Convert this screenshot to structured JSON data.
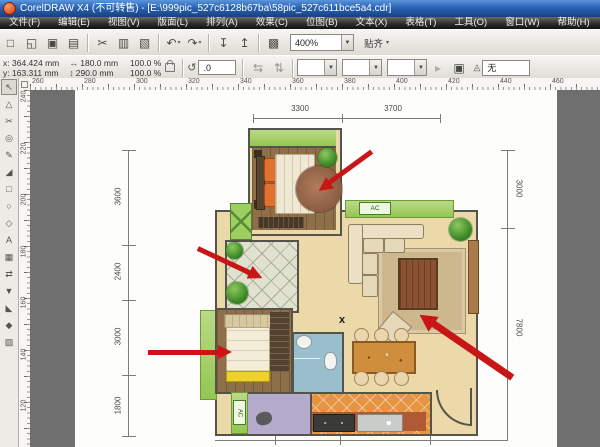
{
  "window": {
    "title": "CorelDRAW X4 (不可转售) - [E:\\999pic_527c6128b67ba\\58pic_527c611bce5a4.cdr]"
  },
  "menubar": {
    "items": [
      "文件(F)",
      "编辑(E)",
      "视图(V)",
      "版面(L)",
      "排列(A)",
      "效果(C)",
      "位图(B)",
      "文本(X)",
      "表格(T)",
      "工具(O)",
      "窗口(W)",
      "帮助(H)"
    ]
  },
  "toolbar": {
    "icons": [
      {
        "name": "new-document-icon",
        "glyph": "□"
      },
      {
        "name": "open-icon",
        "glyph": "◱"
      },
      {
        "name": "save-icon",
        "glyph": "▣"
      },
      {
        "name": "print-icon",
        "glyph": "▤"
      },
      {
        "sep": true
      },
      {
        "name": "cut-icon",
        "glyph": "✂"
      },
      {
        "name": "copy-icon",
        "glyph": "▥"
      },
      {
        "name": "paste-icon",
        "glyph": "▧"
      },
      {
        "sep": true
      },
      {
        "name": "undo-icon",
        "glyph": "↶",
        "caret": true
      },
      {
        "name": "redo-icon",
        "glyph": "↷",
        "caret": true
      },
      {
        "sep": true
      },
      {
        "name": "import-icon",
        "glyph": "↧"
      },
      {
        "name": "export-icon",
        "glyph": "↥"
      },
      {
        "sep": true
      },
      {
        "name": "app-launcher-icon",
        "glyph": "▩"
      }
    ],
    "zoom_value": "400%",
    "snap_label": "贴齐",
    "snap_caret": "▾"
  },
  "property_bar": {
    "x_label": "x:",
    "x_value": "364.424 mm",
    "y_label": "y:",
    "y_value": "163.311 mm",
    "w_value": "180.0 mm",
    "h_value": "290.0 mm",
    "scale_h": "100.0",
    "scale_v": "100.0",
    "percent": "%",
    "angle_value": ".0",
    "outline_value": "无"
  },
  "rulers": {
    "horizontal": [
      "260",
      "280",
      "300",
      "320",
      "340",
      "360",
      "380",
      "400",
      "420",
      "440",
      "460"
    ],
    "vertical": [
      "240",
      "220",
      "200",
      "180",
      "160",
      "140",
      "120"
    ]
  },
  "toolbox": {
    "tools": [
      {
        "name": "pick-tool",
        "glyph": "↖",
        "active": true
      },
      {
        "name": "shape-tool",
        "glyph": "△"
      },
      {
        "name": "crop-tool",
        "glyph": "✂"
      },
      {
        "name": "zoom-tool",
        "glyph": "◎"
      },
      {
        "name": "freehand-tool",
        "glyph": "✎"
      },
      {
        "name": "smart-fill-tool",
        "glyph": "◢"
      },
      {
        "name": "rectangle-tool",
        "glyph": "□"
      },
      {
        "name": "ellipse-tool",
        "glyph": "○"
      },
      {
        "name": "polygon-tool",
        "glyph": "◇"
      },
      {
        "name": "text-tool",
        "glyph": "A"
      },
      {
        "name": "table-tool",
        "glyph": "▦"
      },
      {
        "name": "interactive-blend-tool",
        "glyph": "⇄"
      },
      {
        "name": "eyedropper-tool",
        "glyph": "▼"
      },
      {
        "name": "outline-pen-tool",
        "glyph": "◣"
      },
      {
        "name": "fill-tool",
        "glyph": "◆"
      },
      {
        "name": "interactive-fill-tool",
        "glyph": "▨"
      }
    ]
  },
  "floorplan": {
    "dims_top": [
      "3300",
      "3700"
    ],
    "dims_left": [
      "3600",
      "2400",
      "3000",
      "1800"
    ],
    "dims_right": [
      "3000",
      "7800"
    ],
    "ac_label_1": "AC",
    "ac_label_2": "AC",
    "center_marker": "x"
  },
  "colors": {
    "arrow_red": "#c81616",
    "balcony_green": "#94c653",
    "wood_floor": "#8f6f48",
    "living_beige": "#ecd9aa",
    "bath_blue": "#9abfcc",
    "balcony_purple": "#b4abcd",
    "kitchen_orange": "#e59440",
    "pasteboard_gray": "#6f6f6f"
  }
}
